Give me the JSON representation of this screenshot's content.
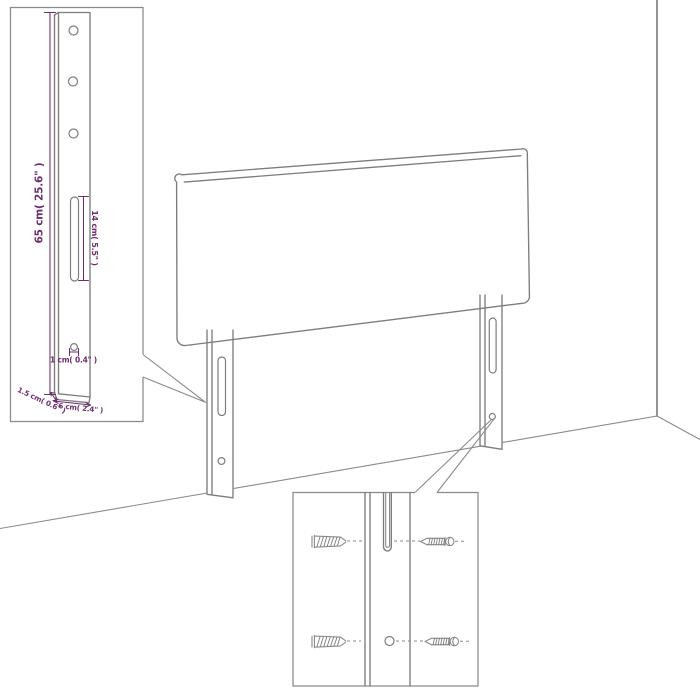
{
  "colors": {
    "background": "#ffffff",
    "line": "#7d7d7d",
    "wall_line": "#8f8f8f",
    "annotation": "#6d2d6d"
  },
  "main_drawing": {
    "subject": "headboard-with-two-mounting-legs",
    "scene": [
      "wall-corner",
      "floor-lines"
    ]
  },
  "inset_top_left": {
    "subject": "mounting-leg-detail",
    "dimensions": {
      "height": "65 cm( 25.6\" )",
      "slot_length": "14 cm( 5.5\" )",
      "hole_diameter": "1 cm( 0.4\" )",
      "depth": "1.5 cm( 0.6\" )",
      "width": "6 cm( 2.4\" )"
    }
  },
  "inset_bottom_right": {
    "subject": "wall-mounting-hardware-detail",
    "icons": [
      "wall-plug-icon",
      "screw-icon",
      "leg-slot",
      "leg-hole"
    ]
  }
}
